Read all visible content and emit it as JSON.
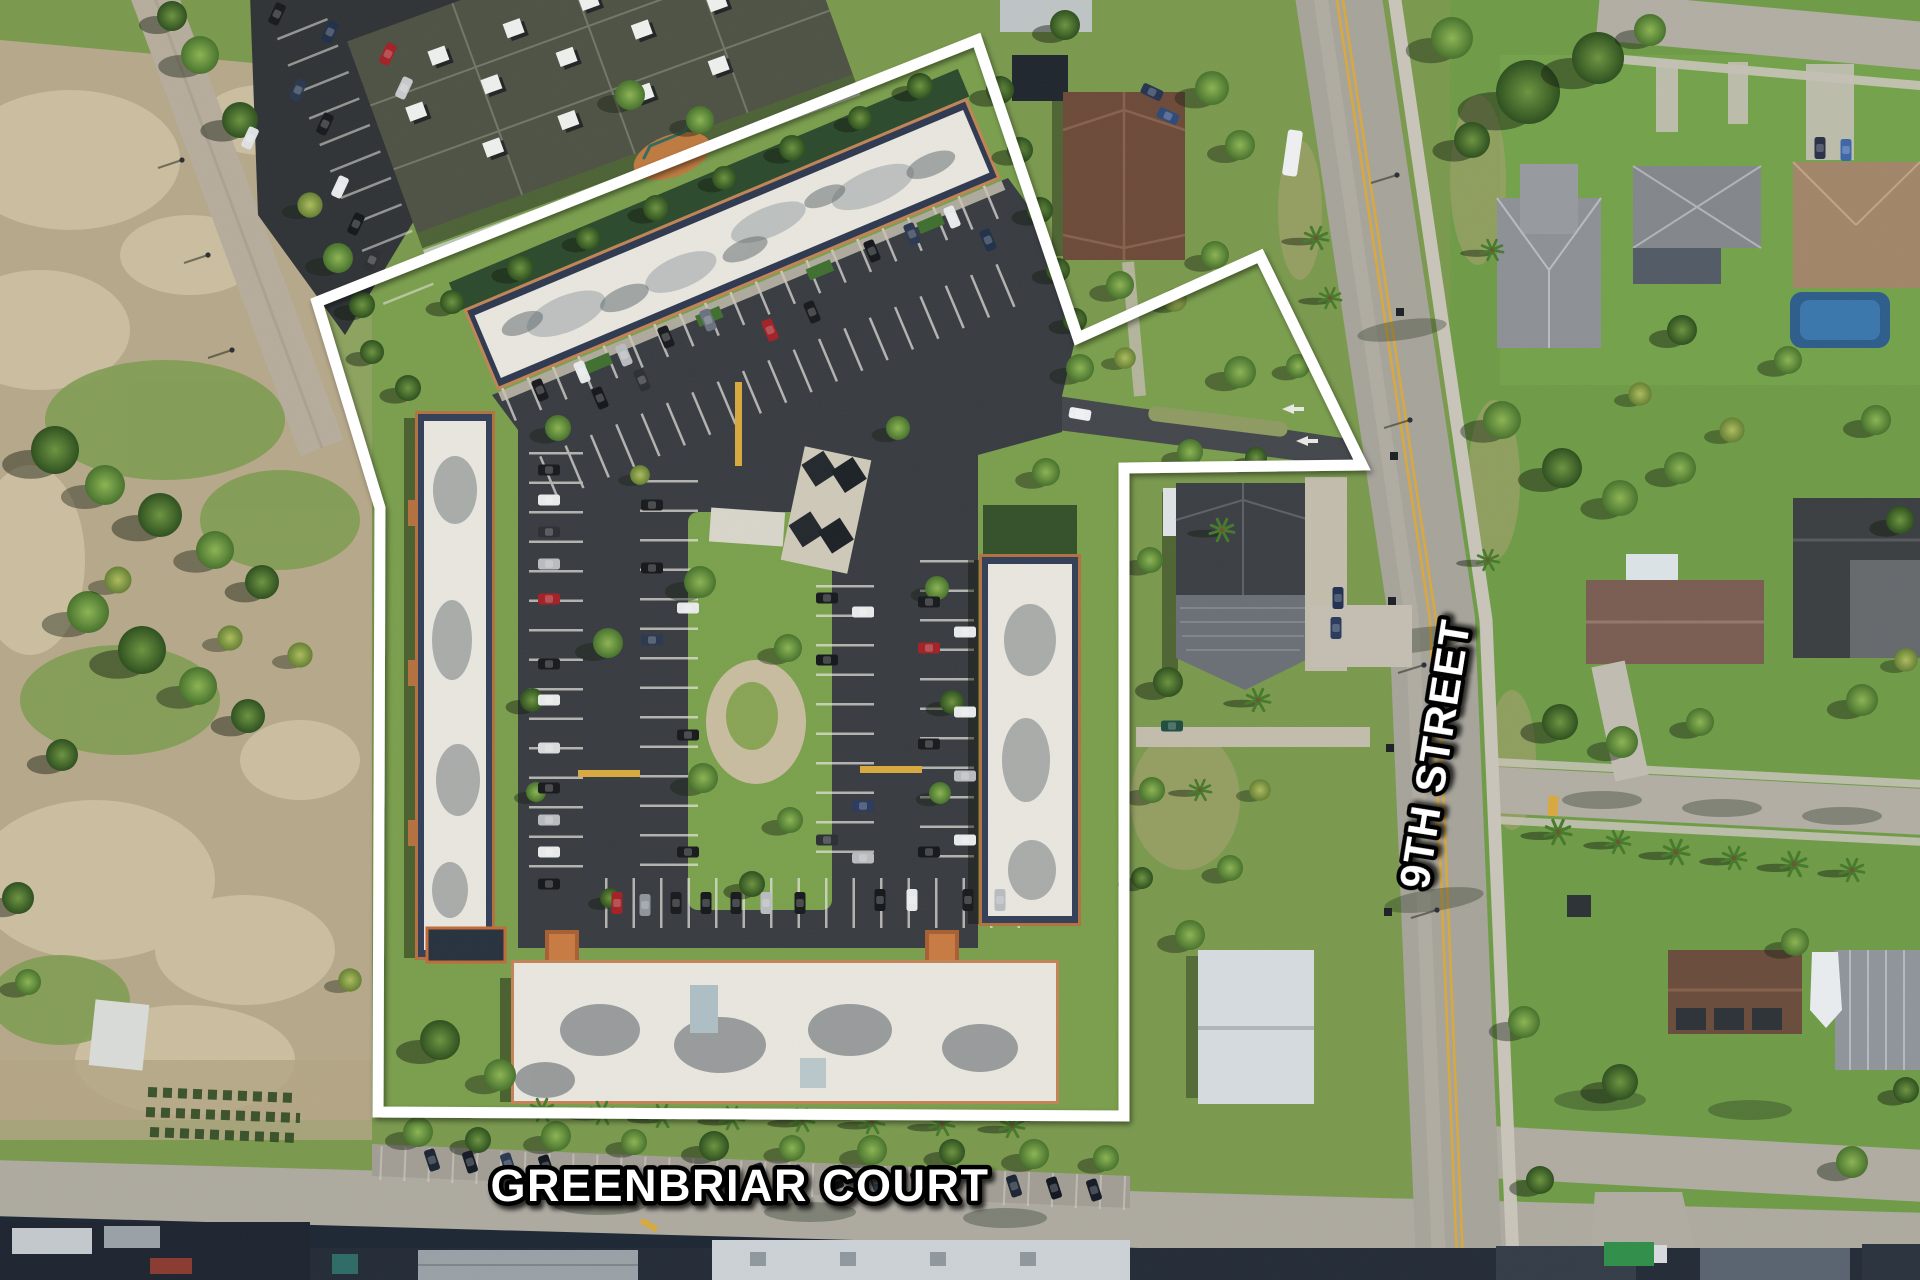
{
  "labels": {
    "street_bottom": "GREENBRIAR COURT",
    "street_right": "9TH STREET"
  },
  "colors": {
    "boundary": "#ffffff",
    "label_fill": "#ffffff",
    "label_outline": "#000000",
    "centerline_yellow": "#d9a93e",
    "asphalt": "#383c42",
    "concrete_road": "#aba79e",
    "grass": "#7a9a4e",
    "sand_lot": "#b7a88a",
    "roof_white": "#e9e7df",
    "roof_trim_orange": "#c28457",
    "house_roof_brown": "#6d4a39"
  }
}
